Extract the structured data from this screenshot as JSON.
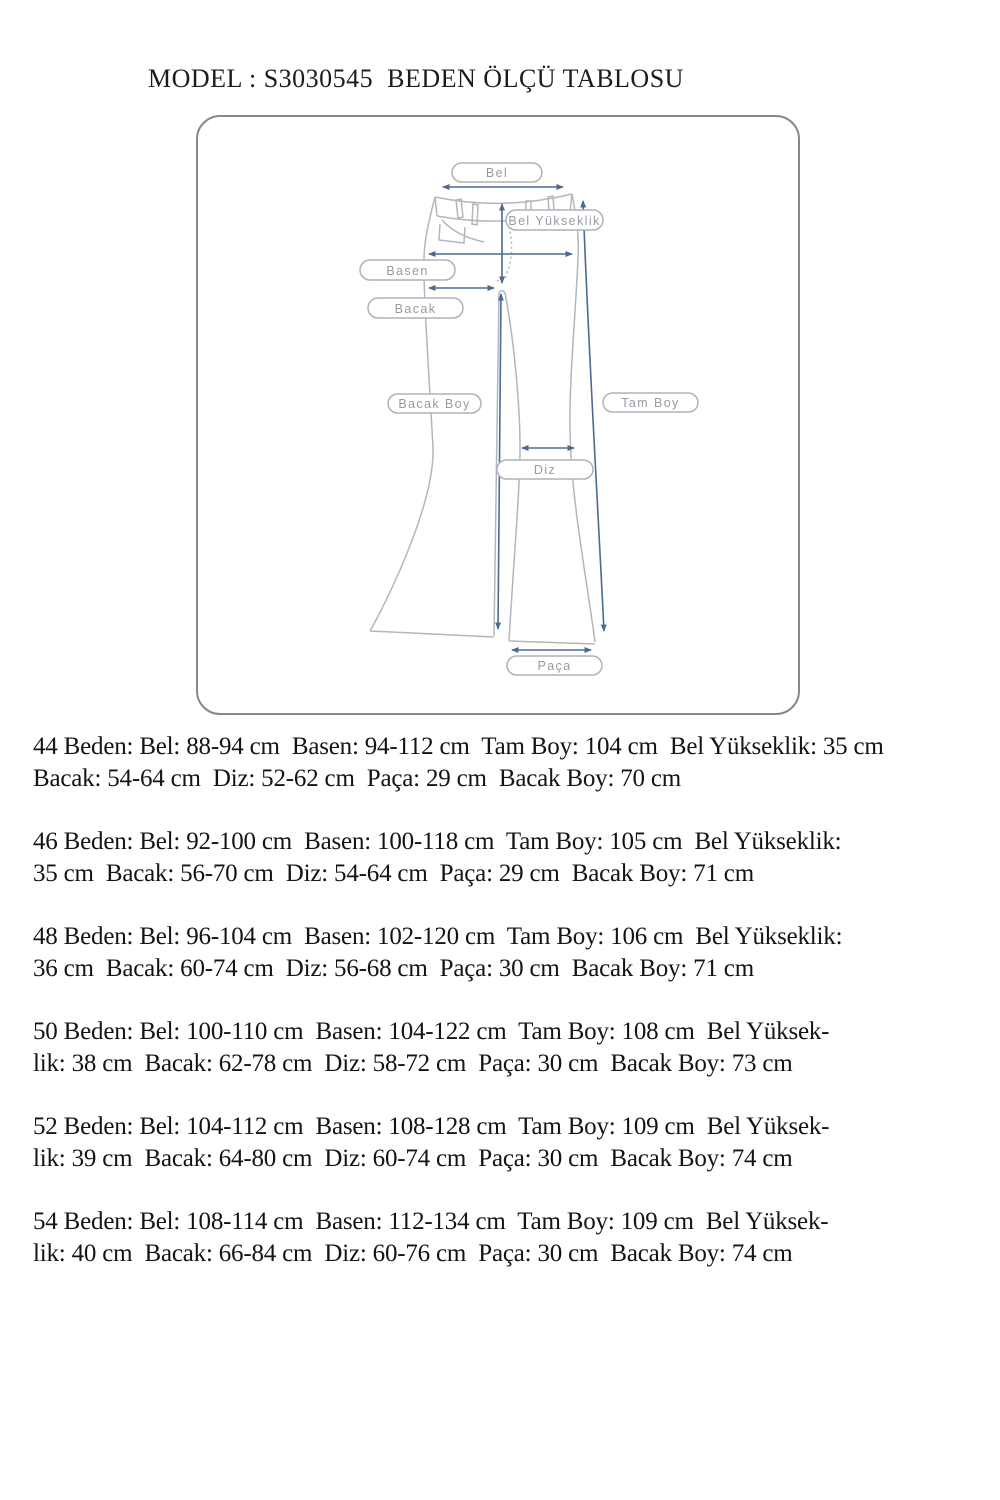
{
  "page": {
    "title": "MODEL : S3030545  BEDEN ÖLÇÜ TABLOSU"
  },
  "diagram": {
    "labels": {
      "bel": "Bel",
      "bel_yukseklik": "Bel Yükseklik",
      "basen": "Basen",
      "bacak": "Bacak",
      "bacak_boy": "Bacak Boy",
      "tam_boy": "Tam Boy",
      "diz": "Diz",
      "paca": "Paça"
    },
    "colors": {
      "arrow": "#4b6b93",
      "pants_outline": "#b2b7bd",
      "pill_border": "#aeb3b8",
      "pill_text": "#979ca2",
      "frame_border": "#85898e"
    }
  },
  "size_rows": [
    {
      "size": "44",
      "line1": "44 Beden: Bel: 88-94 cm  Basen: 94-112 cm  Tam Boy: 104 cm  Bel Yükseklik: 35 cm",
      "line2": "Bacak: 54-64 cm  Diz: 52-62 cm  Paça: 29 cm  Bacak Boy: 70 cm"
    },
    {
      "size": "46",
      "line1": "46 Beden: Bel: 92-100 cm  Basen: 100-118 cm  Tam Boy: 105 cm  Bel Yükseklik:",
      "line2": "35 cm  Bacak: 56-70 cm  Diz: 54-64 cm  Paça: 29 cm  Bacak Boy: 71 cm"
    },
    {
      "size": "48",
      "line1": "48 Beden: Bel: 96-104 cm  Basen: 102-120 cm  Tam Boy: 106 cm  Bel Yükseklik:",
      "line2": "36 cm  Bacak: 60-74 cm  Diz: 56-68 cm  Paça: 30 cm  Bacak Boy: 71 cm"
    },
    {
      "size": "50",
      "line1": "50 Beden: Bel: 100-110 cm  Basen: 104-122 cm  Tam Boy: 108 cm  Bel Yüksek-",
      "line2": "lik: 38 cm  Bacak: 62-78 cm  Diz: 58-72 cm  Paça: 30 cm  Bacak Boy: 73 cm"
    },
    {
      "size": "52",
      "line1": "52 Beden: Bel: 104-112 cm  Basen: 108-128 cm  Tam Boy: 109 cm  Bel Yüksek-",
      "line2": "lik: 39 cm  Bacak: 64-80 cm  Diz: 60-74 cm  Paça: 30 cm  Bacak Boy: 74 cm"
    },
    {
      "size": "54",
      "line1": "54 Beden: Bel: 108-114 cm  Basen: 112-134 cm  Tam Boy: 109 cm  Bel Yüksek-",
      "line2": "lik: 40 cm  Bacak: 66-84 cm  Diz: 60-76 cm  Paça: 30 cm  Bacak Boy: 74 cm"
    }
  ],
  "measurements_table": {
    "type": "table",
    "columns": [
      "Beden",
      "Bel",
      "Basen",
      "Tam Boy",
      "Bel Yükseklik",
      "Bacak",
      "Diz",
      "Paça",
      "Bacak Boy"
    ],
    "rows": [
      [
        "44",
        "88-94 cm",
        "94-112 cm",
        "104 cm",
        "35 cm",
        "54-64 cm",
        "52-62 cm",
        "29 cm",
        "70 cm"
      ],
      [
        "46",
        "92-100 cm",
        "100-118 cm",
        "105 cm",
        "35 cm",
        "56-70 cm",
        "54-64 cm",
        "29 cm",
        "71 cm"
      ],
      [
        "48",
        "96-104 cm",
        "102-120 cm",
        "106 cm",
        "36 cm",
        "60-74 cm",
        "56-68 cm",
        "30 cm",
        "71 cm"
      ],
      [
        "50",
        "100-110 cm",
        "104-122 cm",
        "108 cm",
        "38 cm",
        "62-78 cm",
        "58-72 cm",
        "30 cm",
        "73 cm"
      ],
      [
        "52",
        "104-112 cm",
        "108-128 cm",
        "109 cm",
        "39 cm",
        "64-80 cm",
        "60-74 cm",
        "30 cm",
        "74 cm"
      ],
      [
        "54",
        "108-114 cm",
        "112-134 cm",
        "109 cm",
        "40 cm",
        "66-84 cm",
        "60-76 cm",
        "30 cm",
        "74 cm"
      ]
    ]
  }
}
